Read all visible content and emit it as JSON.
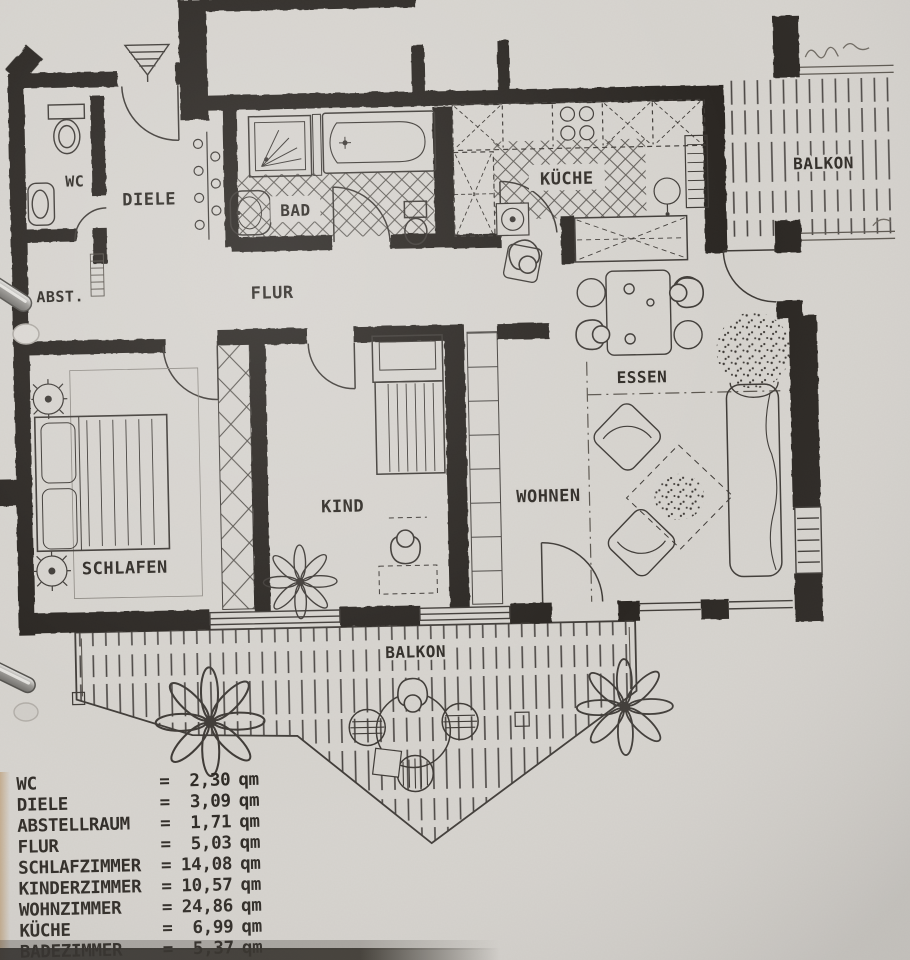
{
  "rooms": {
    "wc": "WC",
    "diele": "DIELE",
    "abstellraum": "ABST.",
    "bad": "BAD",
    "kueche": "KÜCHE",
    "flur": "FLUR",
    "essen": "ESSEN",
    "schlafzimmer": "SCHLAFEN",
    "kinderzimmer": "KIND",
    "wohnzimmer": "WOHNEN",
    "balkon_oben": "BALKON",
    "balkon_unten": "BALKON"
  },
  "legend": {
    "equals_sign": "=",
    "unit": "qm",
    "rows": [
      {
        "label": "WC",
        "value": "2,30"
      },
      {
        "label": "DIELE",
        "value": "3,09"
      },
      {
        "label": "ABSTELLRAUM",
        "value": "1,71"
      },
      {
        "label": "FLUR",
        "value": "5,03"
      },
      {
        "label": "SCHLAFZIMMER",
        "value": "14,08"
      },
      {
        "label": "KINDERZIMMER",
        "value": "10,57"
      },
      {
        "label": "WOHNZIMMER",
        "value": "24,86"
      },
      {
        "label": "KÜCHE",
        "value": "6,99"
      },
      {
        "label": "BADEZIMMER",
        "value": "5,37"
      }
    ]
  },
  "colors": {
    "paper": "#d7d4cf",
    "wall_ink": "#2b2824",
    "line_ink": "#3f3b37",
    "text_ink": "#2f2b26"
  }
}
